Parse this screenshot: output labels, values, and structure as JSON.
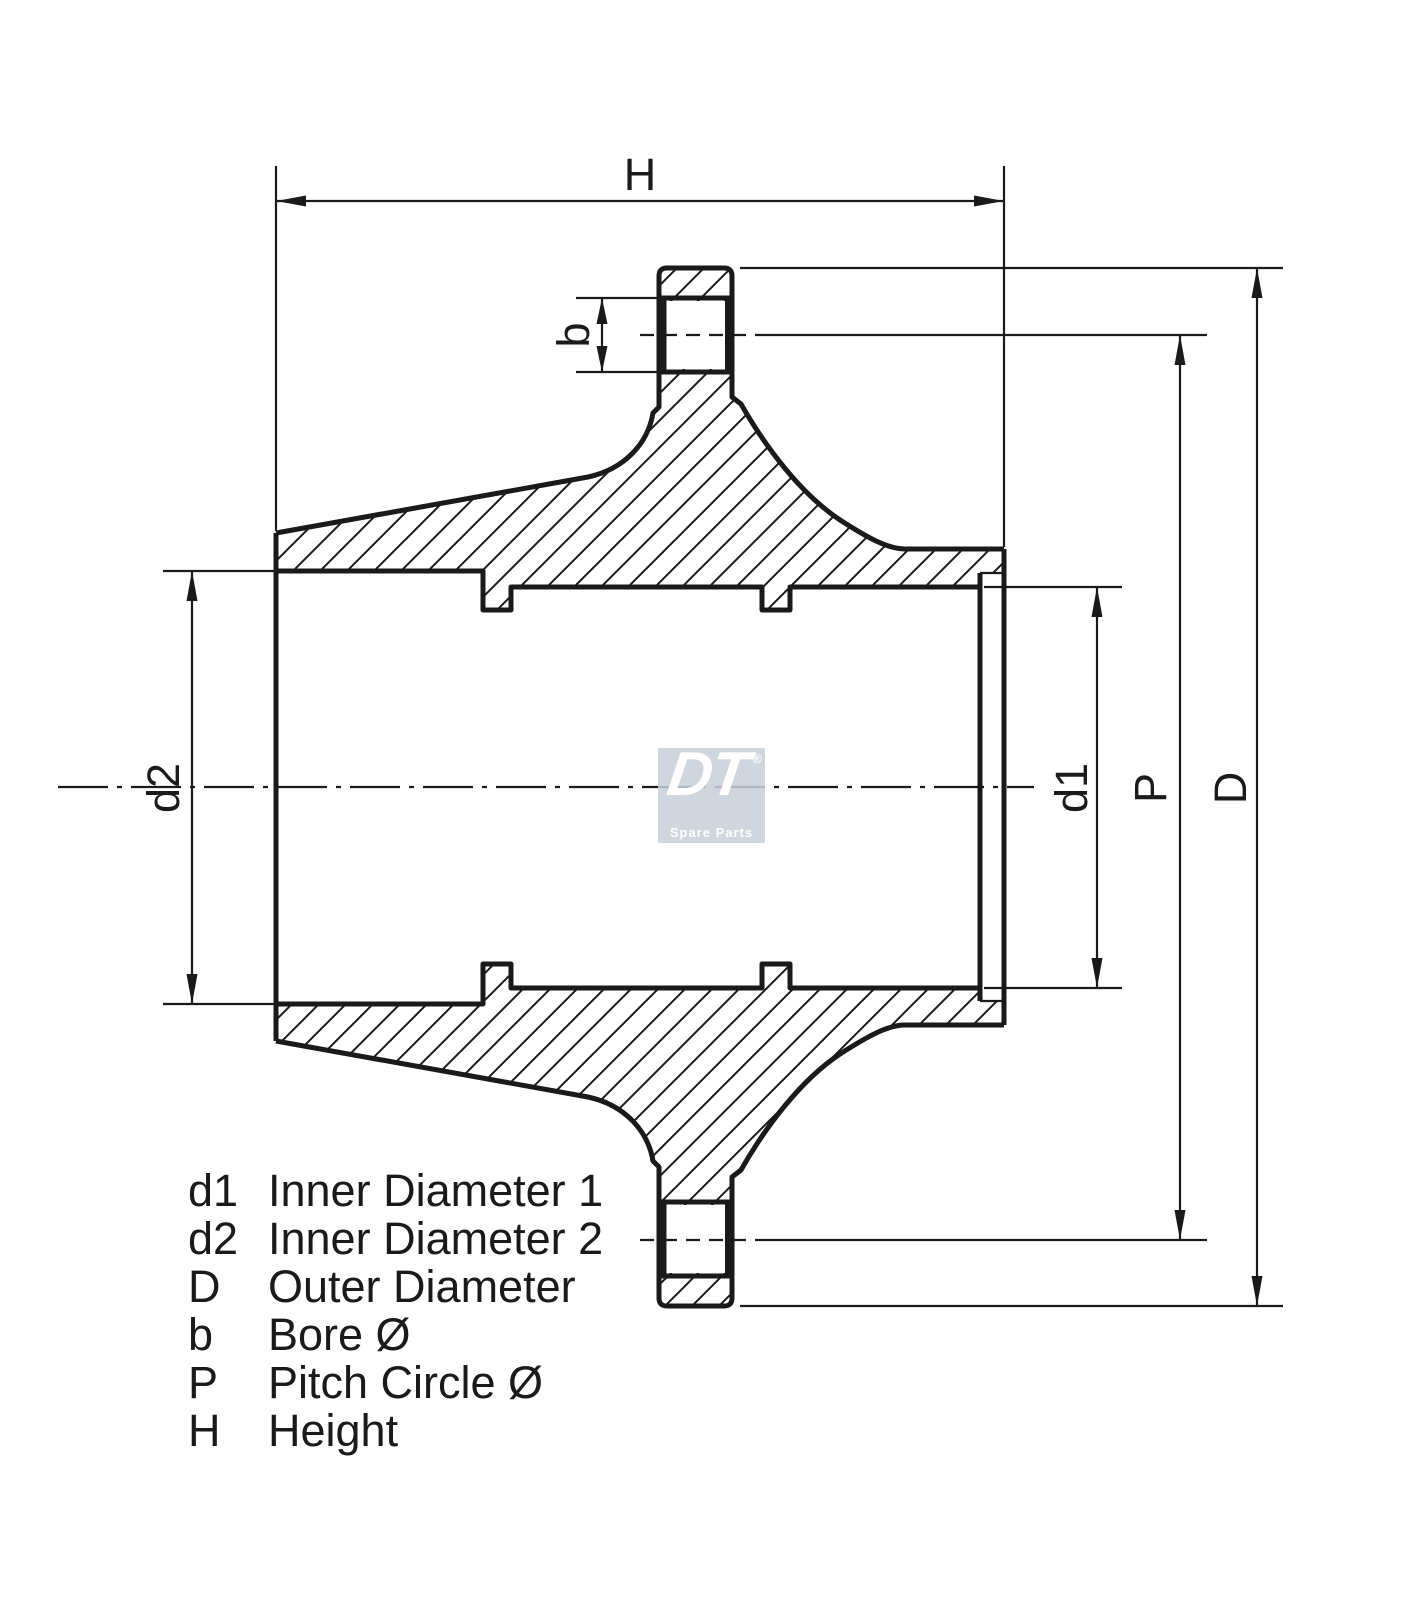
{
  "drawing": {
    "dimension_labels": {
      "height": "H",
      "bore": "b",
      "inner_diameter_2": "d2",
      "inner_diameter_1": "d1",
      "pitch_circle": "P",
      "outer_diameter": "D"
    },
    "legend": {
      "rows": [
        {
          "symbol": "d1",
          "description": "Inner Diameter 1"
        },
        {
          "symbol": "d2",
          "description": "Inner Diameter 2"
        },
        {
          "symbol": "D",
          "description": "Outer Diameter"
        },
        {
          "symbol": "b",
          "description": "Bore Ø"
        },
        {
          "symbol": "P",
          "description": "Pitch Circle Ø"
        },
        {
          "symbol": "H",
          "description": "Height"
        }
      ]
    },
    "watermark": {
      "brand": "DT",
      "registered": "®",
      "subtitle": "Spare Parts"
    },
    "colors": {
      "line": "#1a1a1a",
      "background": "#ffffff",
      "watermark_bg": "#c8cfd7",
      "watermark_text": "#ffffff"
    }
  }
}
